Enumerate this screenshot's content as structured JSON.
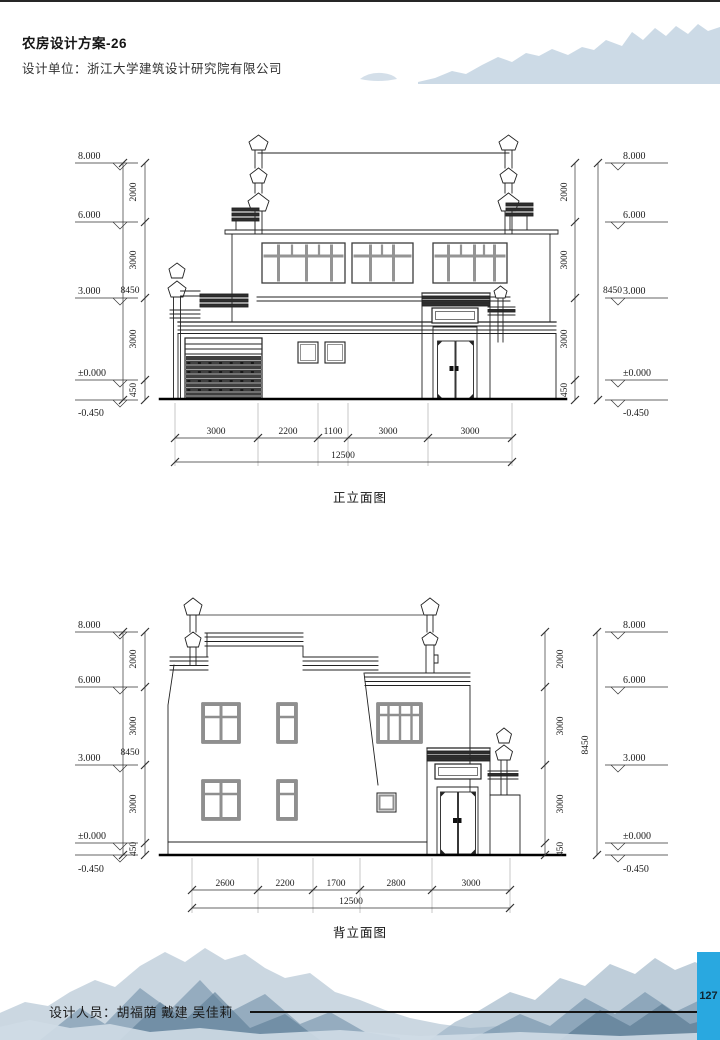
{
  "header": {
    "title": "农房设计方案-26",
    "design_unit": "设计单位：浙江大学建筑设计研究院有限公司"
  },
  "footer": {
    "designers": "设计人员：胡福荫 戴建 吴佳莉",
    "page_number": "127"
  },
  "drawings": [
    {
      "caption": "正立面图",
      "levels": [
        "8.000",
        "6.000",
        "3.000",
        "±0.000",
        "-0.450"
      ],
      "overall_height": "8450",
      "height_segments": [
        "2000",
        "3000",
        "3000",
        "450"
      ],
      "width_segments": [
        "3000",
        "2200",
        "1100",
        "3000",
        "3000"
      ],
      "overall_width": "12500"
    },
    {
      "caption": "背立面图",
      "levels": [
        "8.000",
        "6.000",
        "3.000",
        "±0.000",
        "-0.450"
      ],
      "overall_height": "8450",
      "height_segments": [
        "2000",
        "3000",
        "3000",
        "450"
      ],
      "width_segments": [
        "2600",
        "2200",
        "1700",
        "2800",
        "3000"
      ],
      "overall_width": "12500"
    }
  ]
}
